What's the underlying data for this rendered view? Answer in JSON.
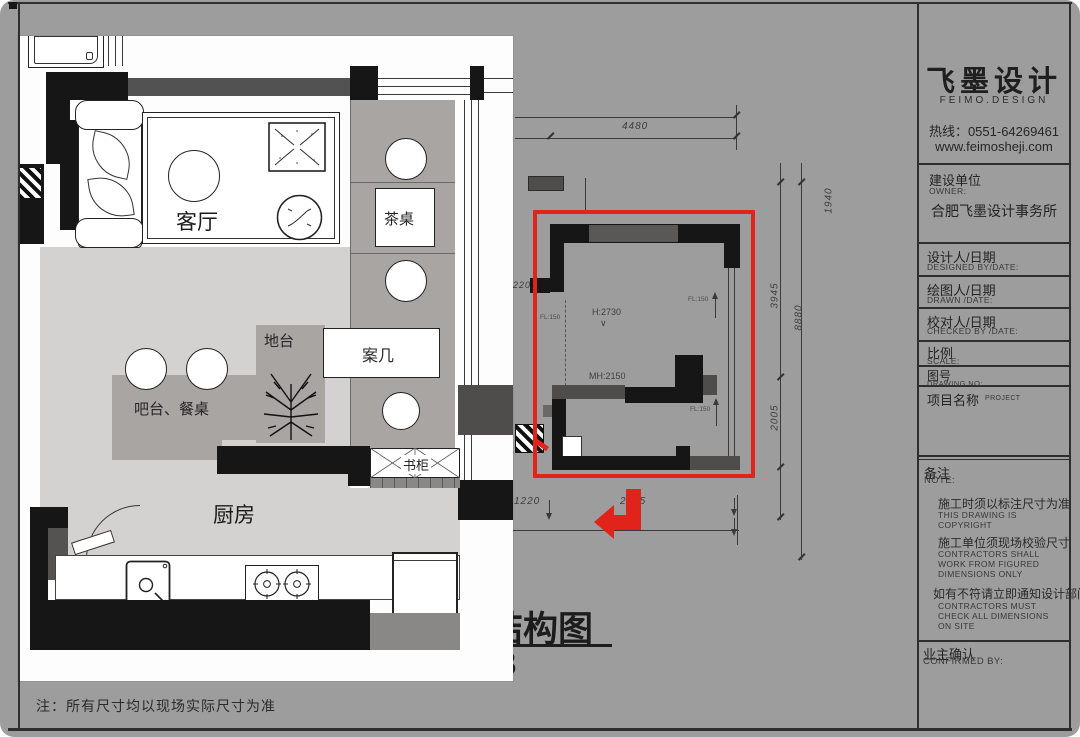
{
  "sheet": {
    "footer_note": "注：所有尺寸均以现场实际尺寸为准"
  },
  "title_block": {
    "brand_name": "飞墨设计",
    "brand_sub": "FEIMO.DESIGN",
    "hotline": "热线：0551-64269461",
    "website": "www.feimosheji.com",
    "owner": {
      "cn": "建设单位",
      "en": "OWNER:",
      "value": "合肥飞墨设计事务所"
    },
    "designed": {
      "cn": "设计人/日期",
      "en": "DESIGNED BY/DATE:"
    },
    "drawn": {
      "cn": "绘图人/日期",
      "en": "DRAWN /DATE:"
    },
    "checked": {
      "cn": "校对人/日期",
      "en": "CHECKED BY /DATE:"
    },
    "scale": {
      "cn": "比例",
      "en": "SCALE:"
    },
    "drawing_no": {
      "cn": "图号",
      "en": "DRAWING NO:"
    },
    "project": {
      "cn": "项目名称",
      "en": "PROJECT"
    },
    "note": {
      "cn": "备注",
      "en": "NOTE:"
    },
    "note_items": [
      {
        "cn": "施工时须以标注尺寸为准",
        "en": "THIS DRAWING IS COPYRIGHT"
      },
      {
        "cn": "施工单位须现场校验尺寸",
        "en": "CONTRACTORS SHALL WORK FROM FIGURED DIMENSIONS ONLY"
      },
      {
        "cn": "如有不符请立即通知设计部门",
        "en": "CONTRACTORS MUST CHECK ALL DIMENSIONS ON SITE"
      }
    ],
    "confirmed": {
      "cn": "业主确认",
      "en": "CONFIRMED BY:"
    }
  },
  "cad": {
    "caption": "结构图",
    "sheet_number": "3",
    "dims": {
      "top": "4480",
      "left": "220",
      "bottom_left": "1220",
      "bottom_right": "2495",
      "right_upper": "1940",
      "right_mid": "3945",
      "right_lower": "2005",
      "right_overall": "8880"
    },
    "ann": {
      "height": "H:2730",
      "opening": "MH:2150",
      "level": "FL:150"
    }
  },
  "plan": {
    "living": "客厅",
    "tea_table": "茶桌",
    "platform": "地台",
    "long_table": "案几",
    "bar_dining": "吧台、餐桌",
    "bookcase": "书柜",
    "kitchen": "厨房"
  }
}
